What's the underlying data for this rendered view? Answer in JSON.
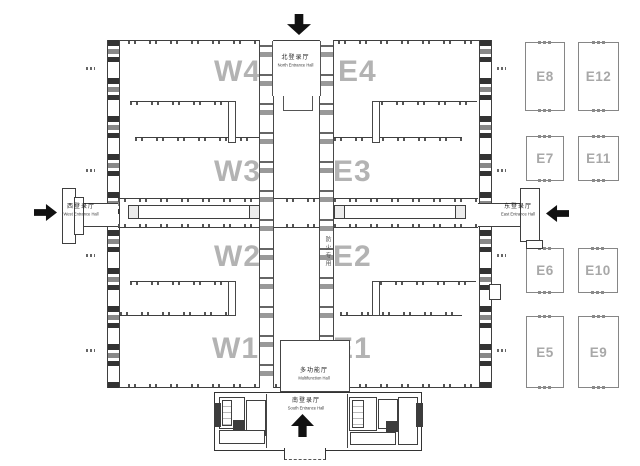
{
  "halls": {
    "W4": "W4",
    "E4": "E4",
    "W3": "W3",
    "E3": "E3",
    "W2": "W2",
    "E2": "E2",
    "W1": "W1",
    "E1": "E1"
  },
  "outdoor_halls": {
    "E8": "E8",
    "E12": "E12",
    "E7": "E7",
    "E11": "E11",
    "E6": "E6",
    "E10": "E10",
    "E5": "E5",
    "E9": "E9"
  },
  "entrances": {
    "north": {
      "cn": "北登录厅",
      "en": "North Entrance Hall"
    },
    "south": {
      "cn": "南登录厅",
      "en": "South Entrance Hall"
    },
    "west": {
      "cn": "西登录厅",
      "en": "West Entrance Hall"
    },
    "east": {
      "cn": "东登录厅",
      "en": "East Entrance Hall"
    }
  },
  "annotations": {
    "multifunction": {
      "cn": "多功能厅",
      "en": "Multifunction Hall"
    },
    "fire_lane": "防火专用"
  },
  "colors": {
    "line": "#3f3f3f",
    "hall_label": "#b3b3b3",
    "outdoor_border": "#868686",
    "arrow": "#111111"
  }
}
